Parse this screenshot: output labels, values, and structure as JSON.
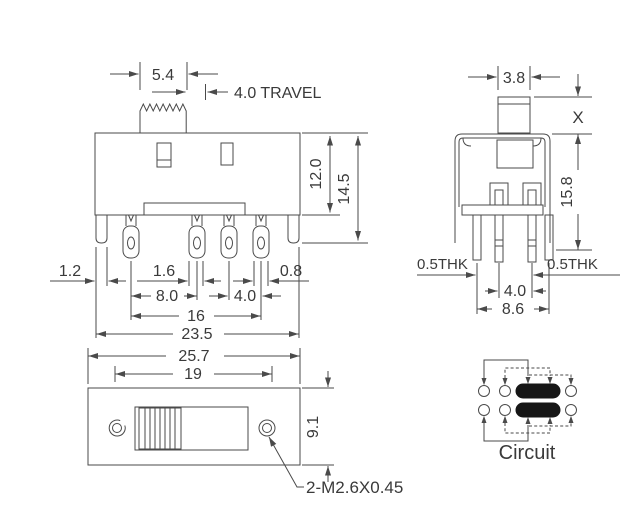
{
  "front_view": {
    "knob_width": "5.4",
    "travel": "4.0 TRAVEL",
    "body_height": "12.0",
    "total_height": "14.5",
    "leg_width": "1.2",
    "lug_width": "1.6",
    "lug_offset": "0.8",
    "pitch_a": "8.0",
    "pitch_b": "4.0",
    "lug_span": "16",
    "leg_span": "23.5"
  },
  "bottom_view": {
    "overall_width": "25.7",
    "slot_width": "19",
    "body_depth": "9.1",
    "mounting_hole": "2-M2.6X0.45"
  },
  "side_view": {
    "knob_width": "3.8",
    "knob_height": "X",
    "body_height": "15.8",
    "thk_left": "0.5THK",
    "thk_right": "0.5THK",
    "pin_row_pitch": "4.0",
    "pin_row_span": "8.6"
  },
  "circuit": {
    "caption": "Circuit"
  },
  "colors": {
    "line": "#4a4a4a",
    "text": "#3a3a3a",
    "contact_fill": "#161616",
    "background": "#ffffff"
  }
}
